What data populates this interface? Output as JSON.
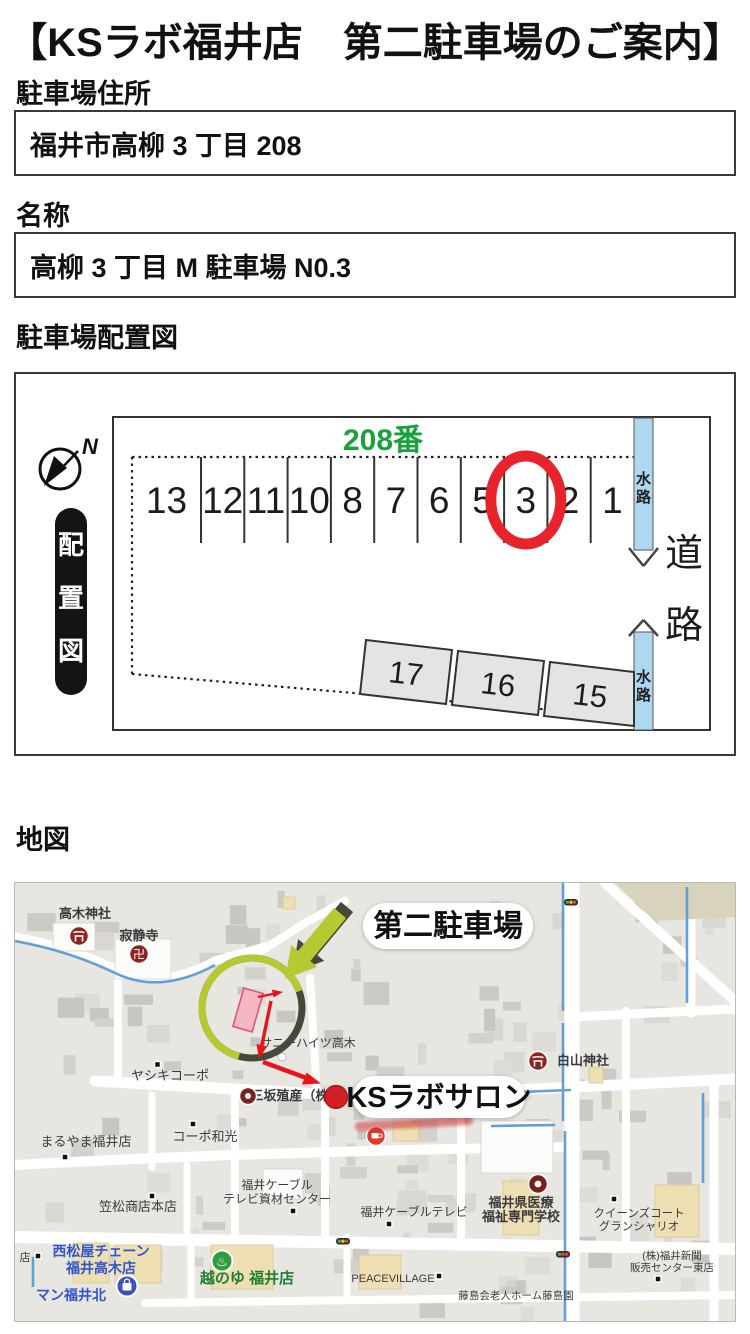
{
  "title": "【KSラボ福井店　第二駐車場のご案内】",
  "address": {
    "label": "駐車場住所",
    "value": "福井市高柳 3 丁目 208"
  },
  "name": {
    "label": "名称",
    "value": "高柳 3 丁目 M 駐車場  N0.3"
  },
  "layout_section": {
    "label": "駐車場配置図"
  },
  "map_section": {
    "label": "地図"
  },
  "diagram": {
    "block_number": "208番",
    "compass_n": "N",
    "legend_chars": {
      "0": "配",
      "1": "置",
      "2": "図"
    },
    "waterway_chars": {
      "0": "水",
      "1": "路"
    },
    "road_chars": {
      "0": "道",
      "1": "路"
    },
    "stalls_top": {
      "0": "13",
      "1": "12",
      "2": "11",
      "3": "10",
      "4": "8",
      "5": "7",
      "6": "6",
      "7": "5",
      "8": "3",
      "9": "2",
      "10": "1"
    },
    "highlighted_stall": "3",
    "stalls_bottom": {
      "0": "17",
      "1": "16",
      "2": "15"
    },
    "colors": {
      "highlight_ring": "#e8232b",
      "waterway_fill": "#aed7f0",
      "block_number_green": "#19a23c"
    }
  },
  "map": {
    "callout_parking": "第二駐車場",
    "callout_salon": "KSラボサロン",
    "pois": {
      "takagi_jinja": "高木神社",
      "jakujoji": "寂静寺",
      "manji": "卍",
      "sunny_heights": "サニーハイツ高木",
      "yashiki_corpo": "ヤシキコーポ",
      "misaka": "三坂殖産（株）",
      "maruyama": "まるやま福井店",
      "corpo_wako": "コーポ和光",
      "kasamatsu": "笠松商店本店",
      "cable_center_1": "福井ケーブル",
      "cable_center_2": "テレビ資材センター",
      "cable_tv": "福井ケーブルテレビ",
      "hakusan": "白山神社",
      "medical_1": "福井県医療",
      "medical_2": "福祉専門学校",
      "queens_1": "クイーンズコート",
      "queens_2": "グランシャリオ",
      "shimbun_1": "(株)福井新聞",
      "shimbun_2": "販売センター東店",
      "peacevillage": "PEACEVILLAGE",
      "fujishima": "藤島会老人ホーム藤島園",
      "nishimatsuya_1": "西松屋チェーン",
      "nishimatsuya_2": "福井高木店",
      "koshinoyu": "越のゆ 福井店",
      "man_fukui": "マン福井北",
      "mise": "店",
      "onsen_mark": "♨"
    }
  }
}
